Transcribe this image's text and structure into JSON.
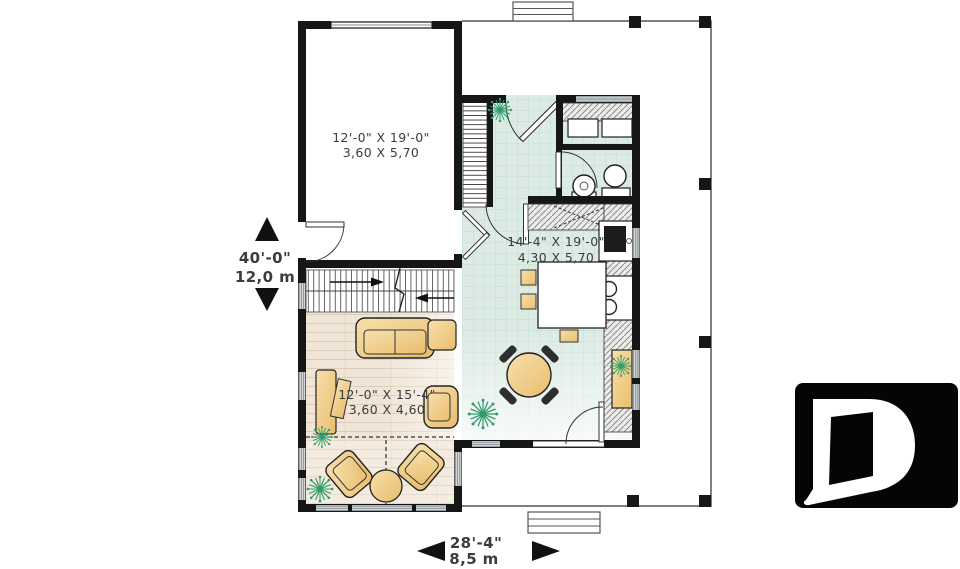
{
  "rooms": {
    "garage": {
      "imperial": "12'-0\" X 19'-0\"",
      "metric": "3,60 X 5,70"
    },
    "kitchen_dining": {
      "imperial": "14'-4\" X 19'-0\"",
      "metric": "4,30 X 5,70"
    },
    "living": {
      "imperial": "12'-0\" X 15'-4\"",
      "metric": "3,60 X 4,60"
    }
  },
  "dimensions": {
    "vertical": {
      "imperial": "40'-0\"",
      "metric": "12,0 m"
    },
    "horizontal": {
      "imperial": "28'-4\"",
      "metric": "8,5 m"
    }
  },
  "logo": {
    "letter": "D"
  },
  "colors": {
    "wall": "#161616",
    "tile-bg": "#dcebe4",
    "tile-line": "#c3ddd2",
    "wood-bg": "#f0e5d6",
    "wood-line": "#dccdb8",
    "furn-light": "#f7e0ac",
    "furn-dark": "#e9bd6c",
    "plant": "#2f9c6a",
    "window": "#8f989b",
    "counter-bg": "#ececea",
    "counter-line": "#8a8a8a",
    "porch-line": "#555555",
    "text": "#3c3c3c",
    "logo-bg": "#050505",
    "logo-letter": "#ffffff"
  }
}
